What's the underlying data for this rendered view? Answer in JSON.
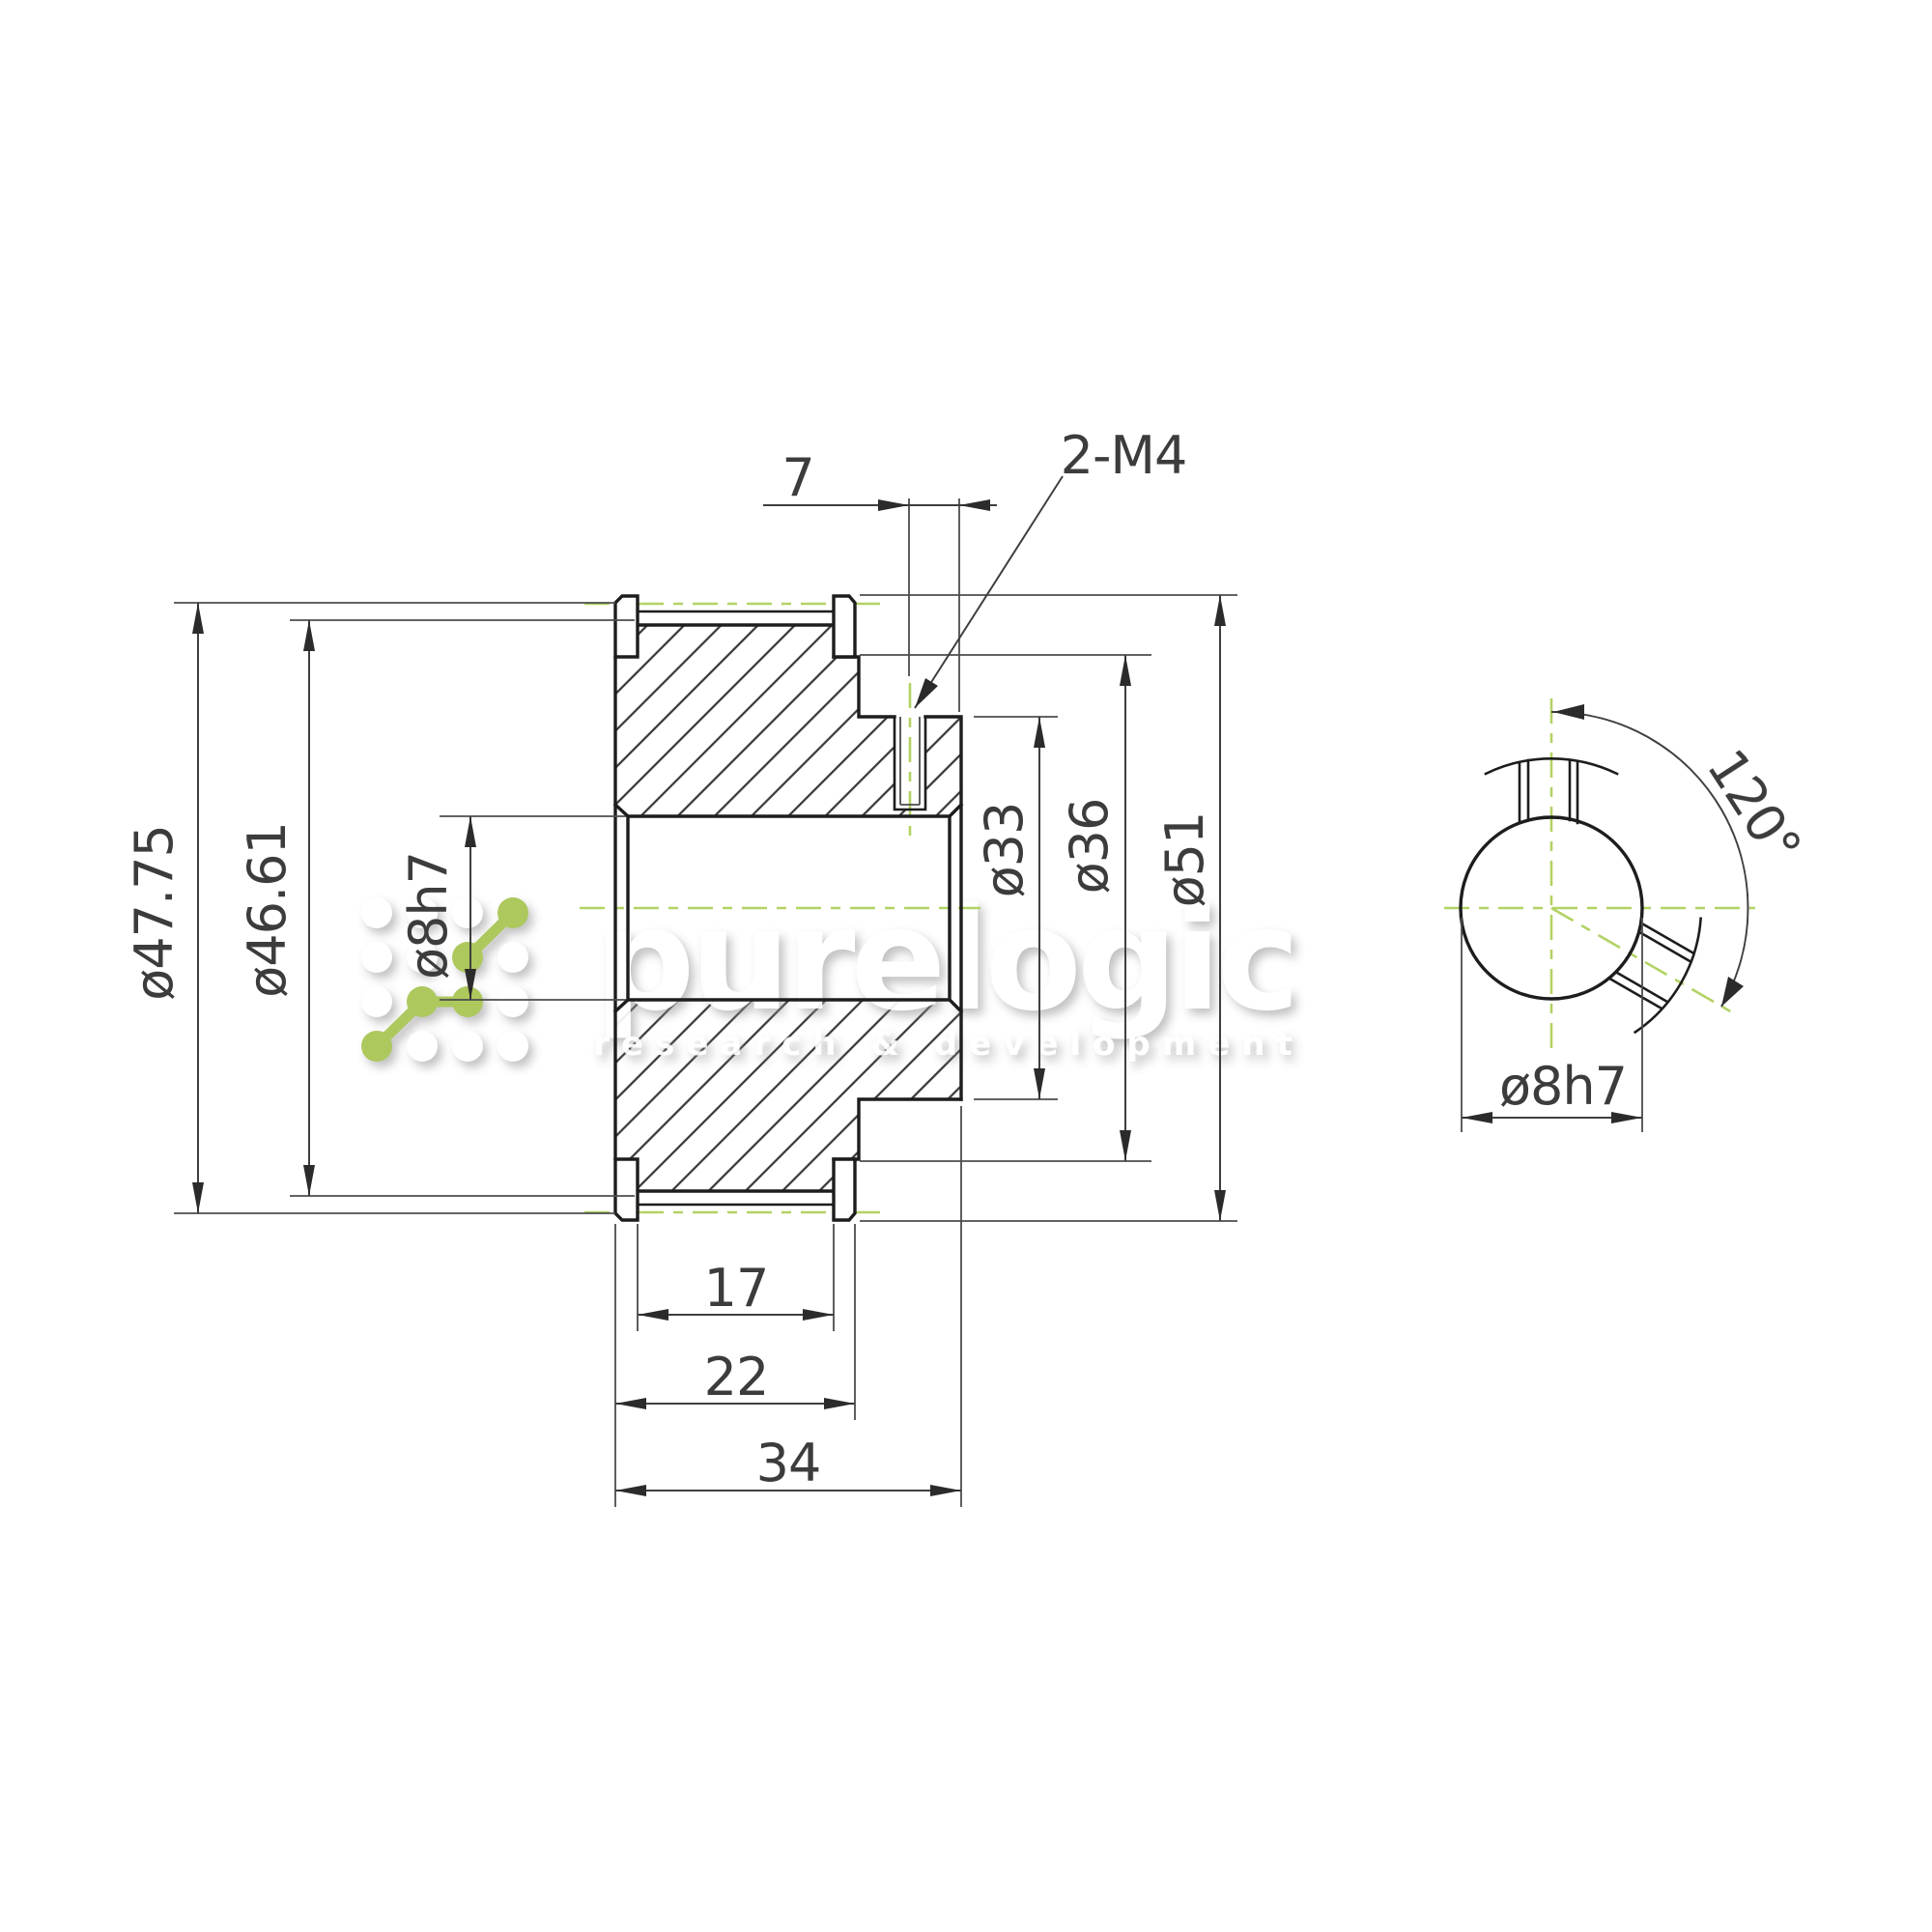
{
  "drawing_type": "mechanical part drawing - timing pulley section and end view",
  "colors": {
    "background": "#ffffff",
    "outline": "#1d1d1d",
    "dimension_lines": "#3f3f3f",
    "centerline_green": "#b3d264",
    "text": "#3c3c3c",
    "watermark_accent_green": "#a6c44f",
    "watermark_white": "#ffffff"
  },
  "labels": {
    "flange_od": "ø47.75",
    "pitch_od": "ø46.61",
    "bore_section": "ø8h7",
    "setscrew_offset": "7",
    "thread_spec": "2-M4",
    "hub_od": "ø33",
    "shoulder_od": "ø36",
    "flange_tip_od": "ø51",
    "belt_width": "17",
    "over_flange_width": "22",
    "total_width": "34",
    "setscrew_angle": "120°",
    "bore_end_view": "ø8h7"
  },
  "watermark": {
    "name": "purelogic",
    "tagline": "research & development"
  }
}
